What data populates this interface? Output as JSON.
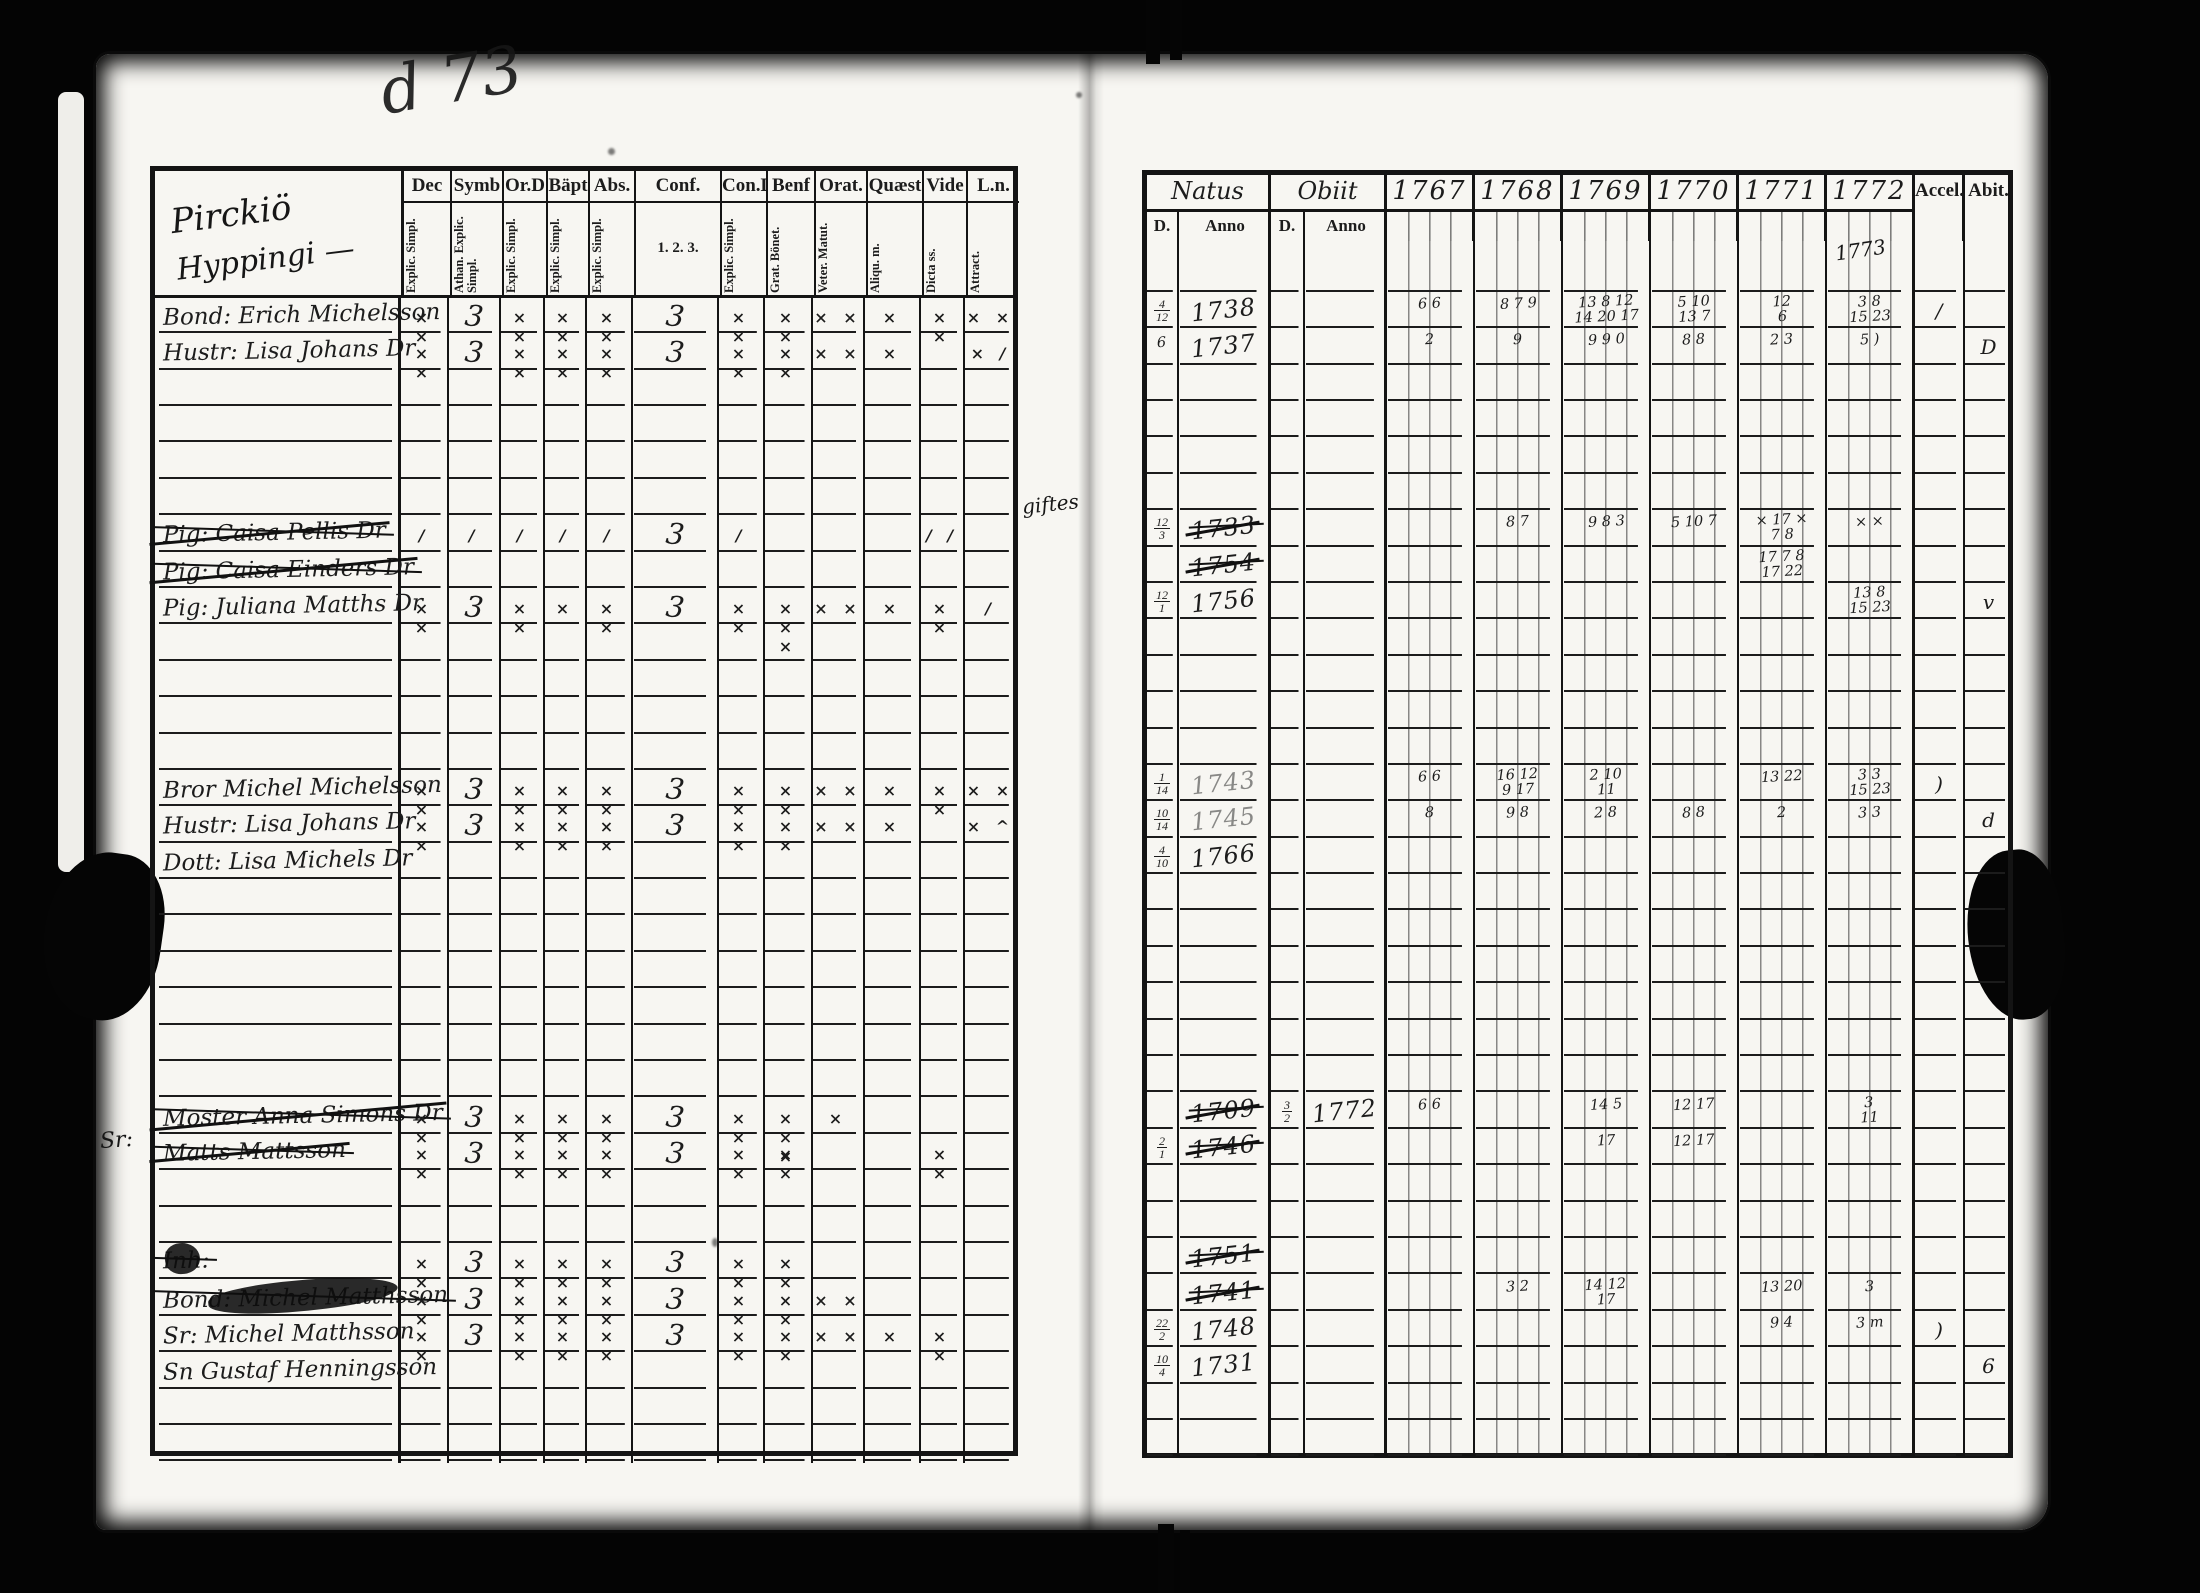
{
  "document": {
    "type": "church-examination-register-scan",
    "ink_color": "#1c1c1c",
    "paper_color": "#f7f6f2",
    "background_color": "#040404"
  },
  "notes": {
    "heading_line1": "Pirckiö",
    "heading_line2": "Hyppingi —",
    "top_scribble": "d 73",
    "year_note": "1773",
    "margin_note": "giftes",
    "sr_note": "Sr:"
  },
  "left": {
    "columns": [
      {
        "label": "Dec",
        "sub": "Explic. Simpl."
      },
      {
        "label": "Symb",
        "sub": "Athan. Explic. Simpl."
      },
      {
        "label": "Or.D",
        "sub": "Explic. Simpl."
      },
      {
        "label": "Bäpt",
        "sub": "Explic. Simpl."
      },
      {
        "label": "Abs.",
        "sub": "Explic. Simpl."
      },
      {
        "label": "Conf.",
        "sub": "1. 2. 3."
      },
      {
        "label": "Con.D",
        "sub": "Explic. Simpl."
      },
      {
        "label": "Benf",
        "sub": "Grat. Bönet."
      },
      {
        "label": "Orat.",
        "sub": "Veter. Matut."
      },
      {
        "label": "Quæst",
        "sub": "Aliqu. m."
      },
      {
        "label": "Vide",
        "sub": "Dicta ss."
      },
      {
        "label": "L.n.",
        "sub": "Attract."
      }
    ],
    "rows": [
      {
        "slot": 1,
        "name": "Bond: Erich Michelsson",
        "struck": false,
        "marks": [
          "× ×",
          "3",
          "× ×",
          "× ×",
          "× ×",
          "3",
          "× ×",
          "× ×",
          "× ×",
          "×",
          "× ×",
          "× ×"
        ]
      },
      {
        "slot": 2,
        "name": "Hustr: Lisa Johans Dr",
        "struck": false,
        "marks": [
          "× ×",
          "3",
          "× ×",
          "× ×",
          "× ×",
          "3",
          "× ×",
          "× ×",
          "× ×",
          "×",
          "",
          "× /"
        ]
      },
      {
        "slot": 7,
        "name": "Pig: Caisa Pellis Dr",
        "struck": true,
        "marks": [
          "/",
          "/",
          "/",
          "/",
          "/",
          "3",
          "/",
          "",
          "",
          "",
          "/ /",
          ""
        ]
      },
      {
        "slot": 8,
        "name": "Pig: Caisa Einders Dr",
        "struck": true,
        "marks": [
          "",
          "",
          "",
          "",
          "",
          "",
          "",
          "",
          "",
          "",
          "",
          ""
        ]
      },
      {
        "slot": 9,
        "name": "Pig: Juliana Matths Dr",
        "struck": false,
        "marks": [
          "× ×",
          "3",
          "× ×",
          "×",
          "× ×",
          "3",
          "× ×",
          "× × ×",
          "× ×",
          "×",
          "× ×",
          "/"
        ]
      },
      {
        "slot": 14,
        "name": "Bror Michel Michelsson",
        "struck": false,
        "marks": [
          "× ×",
          "3",
          "× ×",
          "× ×",
          "× ×",
          "3",
          "× ×",
          "× ×",
          "× ×",
          "×",
          "× ×",
          "× ×"
        ]
      },
      {
        "slot": 15,
        "name": "Hustr: Lisa Johans Dr",
        "struck": false,
        "marks": [
          "× ×",
          "3",
          "× ×",
          "× ×",
          "× ×",
          "3",
          "× ×",
          "× ×",
          "× ×",
          "×",
          "",
          "× ^"
        ]
      },
      {
        "slot": 16,
        "name": "Dott: Lisa Michels Dr",
        "struck": false,
        "marks": [
          "",
          "",
          "",
          "",
          "",
          "",
          "",
          "",
          "",
          "",
          "",
          ""
        ]
      },
      {
        "slot": 23,
        "name": "Moster Anna Simons Dr",
        "struck": true,
        "marks": [
          "× ×",
          "3",
          "× ×",
          "× ×",
          "× ×",
          "3",
          "× ×",
          "× × ×",
          "×",
          "",
          "",
          ""
        ]
      },
      {
        "slot": 24,
        "name": "Matts Mattsson",
        "struck": true,
        "marks": [
          "× ×",
          "3",
          "× ×",
          "× ×",
          "× ×",
          "3",
          "× ×",
          "× ×",
          "",
          "",
          "× ×",
          ""
        ]
      },
      {
        "slot": 27,
        "name": "Inh:",
        "struck": true,
        "blot": true,
        "marks": [
          "× ×",
          "3",
          "× ×",
          "× ×",
          "× ×",
          "3",
          "× ×",
          "× ×",
          "",
          "",
          "",
          ""
        ]
      },
      {
        "slot": 28,
        "name": "Bond: Michel Matthsson",
        "struck": true,
        "blot": true,
        "marks": [
          "× ×",
          "3",
          "× ×",
          "× ×",
          "× ×",
          "3",
          "× ×",
          "× ×",
          "× ×",
          "",
          "",
          ""
        ]
      },
      {
        "slot": 29,
        "name": "Sr: Michel Matthsson",
        "struck": false,
        "marks": [
          "× ×",
          "3",
          "× ×",
          "× ×",
          "× ×",
          "3",
          "× ×",
          "× ×",
          "× ×",
          "×",
          "× ×",
          ""
        ]
      },
      {
        "slot": 30,
        "name": "Sn Gustaf Henningsson",
        "struck": false,
        "marks": [
          "",
          "",
          "",
          "",
          "",
          "",
          "",
          "",
          "",
          "",
          "",
          ""
        ]
      }
    ]
  },
  "right": {
    "natus_label": "Natus",
    "obiit_label": "Obiit",
    "d_label": "D.",
    "anno_label": "Anno",
    "years": [
      "1767",
      "1768",
      "1769",
      "1770",
      "1771",
      "1772"
    ],
    "accel_label": "Accel.",
    "abit_label": "Abit.",
    "rows": [
      {
        "slot": 1,
        "d": "4/12",
        "anno": "1738",
        "struck": false,
        "od": "",
        "oanno": "",
        "y": [
          "6 6",
          "8 7 9",
          "13 8 12\n14 20 17",
          "5 10\n13 7",
          "12\n6",
          "3 8\n15 23"
        ],
        "accel": "/",
        "abit": ""
      },
      {
        "slot": 2,
        "d": "6",
        "anno": "1737",
        "struck": false,
        "od": "",
        "oanno": "",
        "y": [
          "2",
          "9",
          "9 9 0",
          "8 8",
          "2 3",
          "5 )"
        ],
        "accel": "",
        "abit": "D"
      },
      {
        "slot": 7,
        "d": "12/3",
        "anno": "1733",
        "struck": true,
        "od": "",
        "oanno": "",
        "y": [
          "",
          "8 7",
          "9 8 3",
          "5 10 7",
          "× 17 ×\n7 8",
          "× ×"
        ],
        "accel": "",
        "abit": ""
      },
      {
        "slot": 8,
        "d": "",
        "anno": "1754",
        "struck": true,
        "od": "",
        "oanno": "",
        "y": [
          "",
          "",
          "",
          "",
          "17 7 8\n17 22",
          ""
        ],
        "accel": "",
        "abit": ""
      },
      {
        "slot": 9,
        "d": "12/1",
        "anno": "1756",
        "struck": false,
        "od": "",
        "oanno": "",
        "y": [
          "",
          "",
          "",
          "",
          "",
          "13 8\n15 23"
        ],
        "accel": "",
        "abit": "v"
      },
      {
        "slot": 14,
        "d": "1/14",
        "anno": "1743",
        "struck": false,
        "faint": true,
        "od": "",
        "oanno": "",
        "y": [
          "6 6",
          "16 12\n9 17",
          "2 10\n11",
          "",
          "13 22",
          "3 3\n15 23"
        ],
        "accel": ")",
        "abit": ""
      },
      {
        "slot": 15,
        "d": "10/14",
        "anno": "1745",
        "struck": false,
        "faint": true,
        "od": "",
        "oanno": "",
        "y": [
          "8",
          "9 8",
          "2 8",
          "8 8",
          "2",
          "3 3"
        ],
        "accel": "",
        "abit": "d"
      },
      {
        "slot": 16,
        "d": "4/10",
        "anno": "1766",
        "struck": false,
        "od": "",
        "oanno": "",
        "y": [
          "",
          "",
          "",
          "",
          "",
          ""
        ],
        "accel": "",
        "abit": ""
      },
      {
        "slot": 23,
        "d": "",
        "anno": "1709",
        "struck": true,
        "od": "3/2",
        "oanno": "1772",
        "y": [
          "6 6",
          "",
          "14 5",
          "12 17",
          "",
          "3\n11"
        ],
        "accel": "",
        "abit": ""
      },
      {
        "slot": 24,
        "d": "2/1",
        "anno": "1746",
        "struck": true,
        "od": "",
        "oanno": "",
        "y": [
          "",
          "",
          "17",
          "12 17",
          "",
          ""
        ],
        "accel": "",
        "abit": ""
      },
      {
        "slot": 27,
        "d": "",
        "anno": "1751",
        "struck": true,
        "od": "",
        "oanno": "",
        "y": [
          "",
          "",
          "",
          "",
          "",
          ""
        ],
        "accel": "",
        "abit": ""
      },
      {
        "slot": 28,
        "d": "",
        "anno": "1741",
        "struck": true,
        "od": "",
        "oanno": "",
        "y": [
          "",
          "3 2",
          "14 12\n17",
          "",
          "13 20",
          "3"
        ],
        "accel": "",
        "abit": ""
      },
      {
        "slot": 29,
        "d": "22/2",
        "anno": "1748",
        "struck": false,
        "od": "",
        "oanno": "",
        "y": [
          "",
          "",
          "",
          "",
          "9 4",
          "3 m"
        ],
        "accel": ")",
        "abit": ""
      },
      {
        "slot": 30,
        "d": "10/4",
        "anno": "1731",
        "struck": false,
        "od": "",
        "oanno": "",
        "y": [
          "",
          "",
          "",
          "",
          "",
          ""
        ],
        "accel": "",
        "abit": "6"
      }
    ]
  }
}
